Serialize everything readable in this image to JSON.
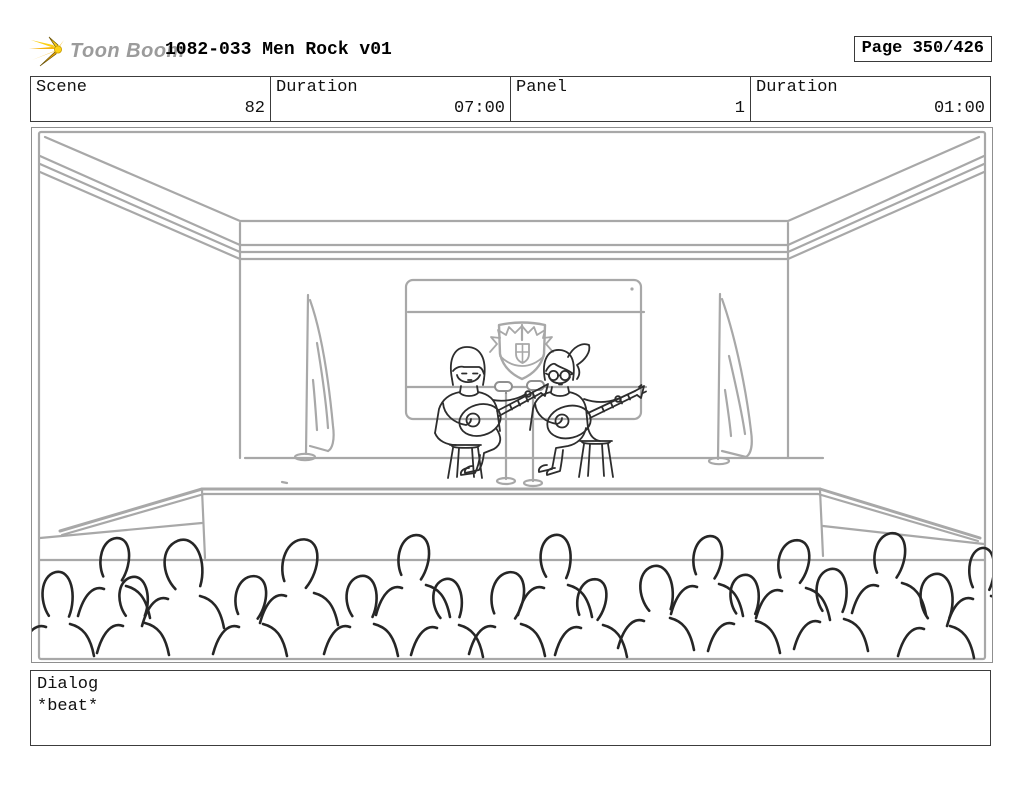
{
  "header": {
    "logo": {
      "brand": "Toon Boom",
      "icon": "toonboom-starburst-icon"
    },
    "title": "1082-033 Men Rock v01",
    "page_indicator": "Page 350/426"
  },
  "info_bar": {
    "cells": [
      {
        "label": "Scene",
        "value": "82"
      },
      {
        "label": "Duration",
        "value": "07:00"
      },
      {
        "label": "Panel",
        "value": "1"
      },
      {
        "label": "Duration",
        "value": "01:00"
      }
    ]
  },
  "storyboard_panel": {
    "scene": "82",
    "panel": "1",
    "description": "Rough pencil sketch of an auditorium: two seated musicians playing acoustic guitars on a stage with two microphone stands, a striped screen bearing an eagle shield crest behind them, drooping flags on poles at each side, a crown-molded ceiling in perspective, and a foreground audience of loose head-and-shoulder outlines."
  },
  "dialog": {
    "label": "Dialog",
    "text": "*beat*"
  },
  "colors": {
    "sketch_gray": "#a8a8a8",
    "ink": "#2d2d2d",
    "logo_yellow": "#f6b40e",
    "brand_gray": "#9b9b9b",
    "background": "#ffffff"
  }
}
